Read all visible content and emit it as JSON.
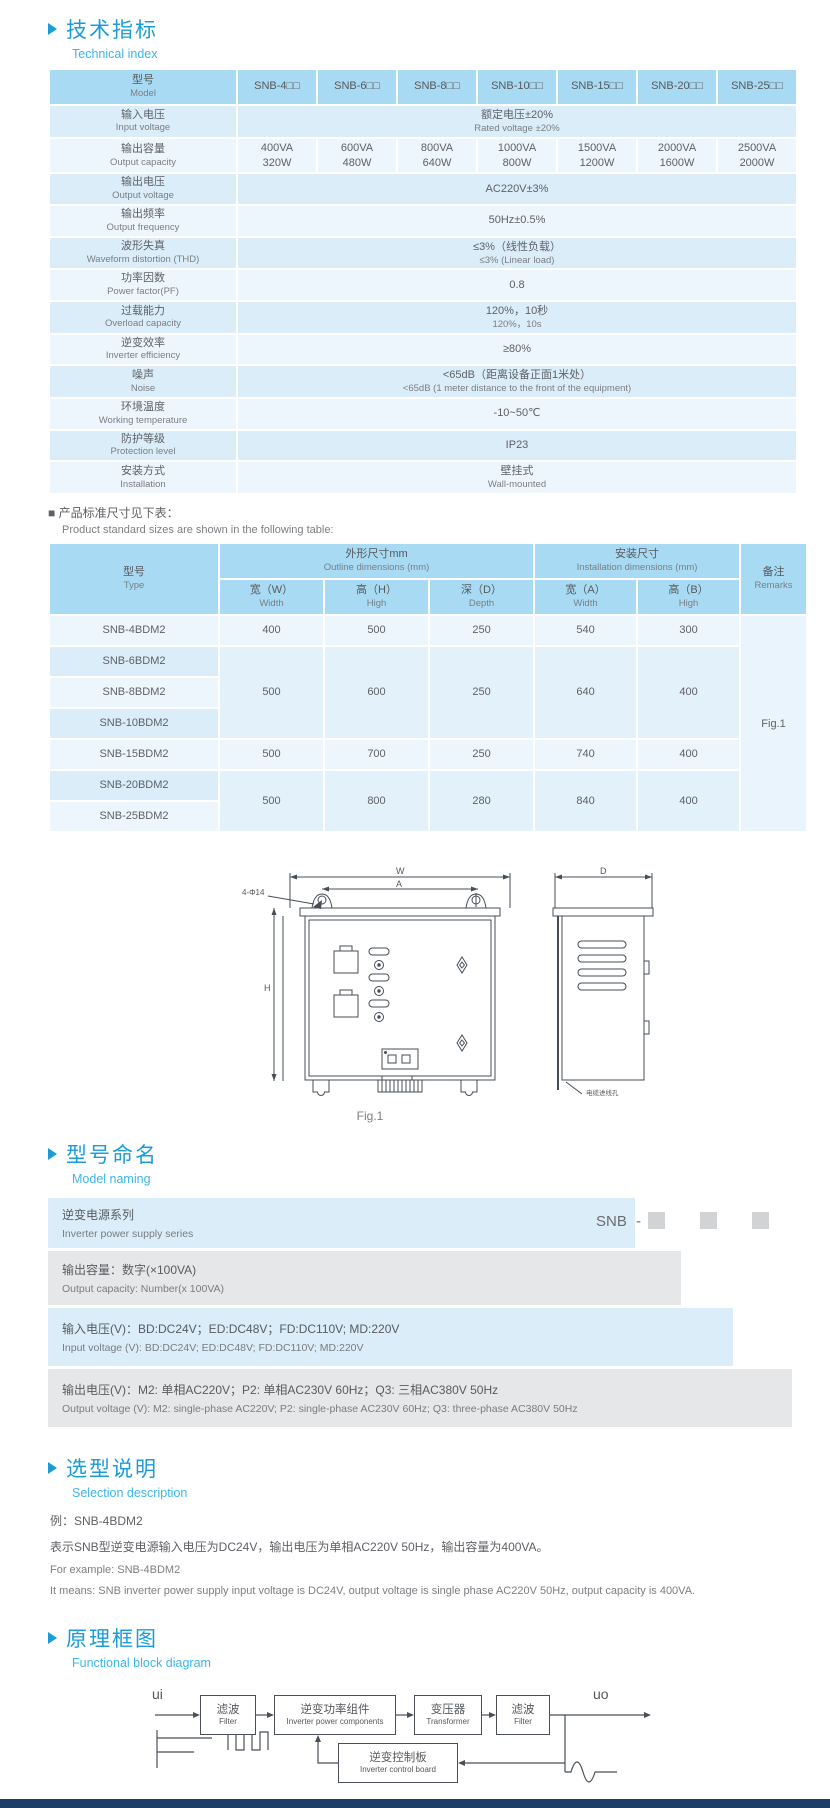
{
  "header1": {
    "zh": "技术指标",
    "en": "Technical index"
  },
  "t1": {
    "model_zh": "型号",
    "model_en": "Model",
    "models": [
      "SNB-4□□",
      "SNB-6□□",
      "SNB-8□□",
      "SNB-10□□",
      "SNB-15□□",
      "SNB-20□□",
      "SNB-25□□"
    ],
    "r": [
      {
        "zh": "输入电压",
        "en": "Input voltage",
        "v1": "额定电压±20%",
        "v2": "Rated voltage ±20%"
      },
      {
        "zh": "输出容量",
        "en": "Output capacity",
        "c": [
          [
            "400VA",
            "320W"
          ],
          [
            "600VA",
            "480W"
          ],
          [
            "800VA",
            "640W"
          ],
          [
            "1000VA",
            "800W"
          ],
          [
            "1500VA",
            "1200W"
          ],
          [
            "2000VA",
            "1600W"
          ],
          [
            "2500VA",
            "2000W"
          ]
        ]
      },
      {
        "zh": "输出电压",
        "en": "Output voltage",
        "v1": "AC220V±3%"
      },
      {
        "zh": "输出频率",
        "en": "Output frequency",
        "v1": "50Hz±0.5%"
      },
      {
        "zh": "波形失真",
        "en": "Waveform distortion (THD)",
        "v1": "≤3%（线性负载）",
        "v2": "≤3% (Linear load)"
      },
      {
        "zh": "功率因数",
        "en": "Power factor(PF)",
        "v1": "0.8"
      },
      {
        "zh": "过载能力",
        "en": "Overload capacity",
        "v1": "120%，10秒",
        "v2": "120%，10s"
      },
      {
        "zh": "逆变效率",
        "en": "Inverter efficiency",
        "v1": "≥80%"
      },
      {
        "zh": "噪声",
        "en": "Noise",
        "v1": "<65dB（距离设备正面1米处）",
        "v2": "<65dB (1 meter distance to the front of the equipment)"
      },
      {
        "zh": "环境温度",
        "en": "Working temperature",
        "v1": "-10~50℃"
      },
      {
        "zh": "防护等级",
        "en": "Protection level",
        "v1": "IP23"
      },
      {
        "zh": "安装方式",
        "en": "Installation",
        "v1": "壁挂式",
        "v2": "Wall-mounted"
      }
    ]
  },
  "note": {
    "zh": "■ 产品标准尺寸见下表：",
    "en": "Product standard sizes are shown in the following table:"
  },
  "t2": {
    "type_zh": "型号",
    "type_en": "Type",
    "outline_zh": "外形尺寸mm",
    "outline_en": "Outline dimensions (mm)",
    "install_zh": "安装尺寸",
    "install_en": "Installation dimensions (mm)",
    "remark_zh": "备注",
    "remark_en": "Remarks",
    "sub": [
      {
        "zh": "宽（W）",
        "en": "Width"
      },
      {
        "zh": "高（H）",
        "en": "High"
      },
      {
        "zh": "深（D）",
        "en": "Depth"
      },
      {
        "zh": "宽（A）",
        "en": "Width"
      },
      {
        "zh": "高（B）",
        "en": "High"
      }
    ],
    "types": [
      "SNB-4BDM2",
      "SNB-6BDM2",
      "SNB-8BDM2",
      "SNB-10BDM2",
      "SNB-15BDM2",
      "SNB-20BDM2",
      "SNB-25BDM2"
    ],
    "g": [
      [
        "400",
        "500",
        "250",
        "540",
        "300"
      ],
      [
        "500",
        "600",
        "250",
        "640",
        "400"
      ],
      [
        "500",
        "700",
        "250",
        "740",
        "400"
      ],
      [
        "500",
        "800",
        "280",
        "840",
        "400"
      ]
    ],
    "remark": "Fig.1"
  },
  "fig": {
    "caption": "Fig.1",
    "w": "W",
    "a": "A",
    "h": "H",
    "d": "D",
    "holes": "4-Φ14",
    "cable_zh": "电缆进线孔",
    "cable_en": "cable inlet hole"
  },
  "header2": {
    "zh": "型号命名",
    "en": "Model naming"
  },
  "naming": {
    "prefix": "SNB",
    "dash": "-",
    "rows": [
      {
        "zh": "逆变电源系列",
        "en": "Inverter power supply series"
      },
      {
        "zh": "输出容量：数字(×100VA)",
        "en": "Output capacity: Number(x 100VA)"
      },
      {
        "zh": "输入电压(V)：BD:DC24V；ED:DC48V；FD:DC110V; MD:220V",
        "en": "Input voltage (V): BD:DC24V;  ED:DC48V;  FD:DC110V; MD:220V"
      },
      {
        "zh": "输出电压(V)：M2: 单相AC220V；P2: 单相AC230V 60Hz；Q3: 三相AC380V 50Hz",
        "en": "Output voltage (V):  M2: single-phase AC220V;  P2: single-phase AC230V 60Hz;  Q3: three-phase AC380V 50Hz"
      }
    ]
  },
  "header3": {
    "zh": "选型说明",
    "en": "Selection description"
  },
  "sel": {
    "l1": "例：SNB-4BDM2",
    "l2": "表示SNB型逆变电源输入电压为DC24V，输出电压为单相AC220V 50Hz，输出容量为400VA。",
    "l3": "For example: SNB-4BDM2",
    "l4": "It means: SNB inverter power supply input voltage is DC24V, output voltage is single phase AC220V 50Hz, output capacity is 400VA."
  },
  "header4": {
    "zh": "原理框图",
    "en": "Functional block diagram"
  },
  "bd": {
    "ui": "ui",
    "uo": "uo",
    "b": [
      {
        "zh": "滤波",
        "en": "Filter"
      },
      {
        "zh": "逆变功率组件",
        "en": "Inverter power components"
      },
      {
        "zh": "变压器",
        "en": "Transformer"
      },
      {
        "zh": "滤波",
        "en": "Filter"
      },
      {
        "zh": "逆变控制板",
        "en": "Inverter control board"
      }
    ]
  },
  "colors": {
    "accent": "#1b9cd8",
    "subtitle": "#3cb6ea",
    "table_header": "#a8daf3",
    "row_dark": "#daedf9",
    "row_light": "#ecf6fc",
    "gray_row": "#e6e7e8",
    "footer": "#1d3e66"
  }
}
